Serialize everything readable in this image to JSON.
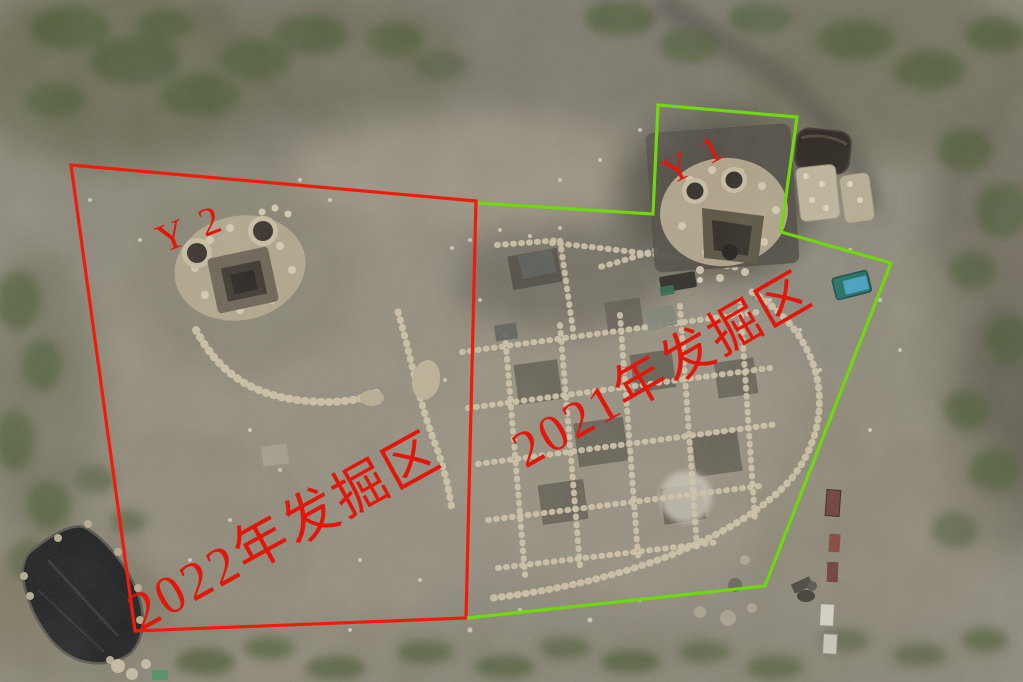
{
  "overlay": {
    "label_color": "#e2170b",
    "red_area": {
      "marker": "Y 2",
      "label": "2022年发掘区",
      "outline_color": "#ee1c0c"
    },
    "green_area": {
      "marker": "Y 1",
      "label": "2021年发掘区",
      "outline_color": "#6fd80f"
    }
  }
}
